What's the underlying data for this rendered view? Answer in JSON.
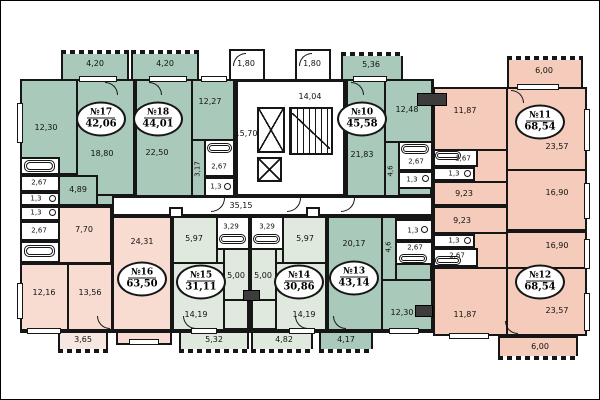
{
  "colors": {
    "apartment_green": "#a9c9ba",
    "apartment_pale_green": "#dfe9dd",
    "apartment_pink": "#f5ccbb",
    "apartment_light_pink": "#f8dcd1",
    "balcony_light_pink": "#f6e7e1",
    "wall": "#161616",
    "background": "#ffffff"
  },
  "core": {
    "entry_left": "1,80",
    "entry_right": "1,80",
    "stairwell": "14,04",
    "elevator_hall": "15,70",
    "corridor": "35,15"
  },
  "apartments": {
    "a17": {
      "number": "№17",
      "area": "42,06",
      "balcony": "4,20",
      "rooms": {
        "room1": "12,30",
        "room2": "18,80",
        "hall": "4,89",
        "bath": "2,67",
        "wc": "1,3"
      }
    },
    "a18": {
      "number": "№18",
      "area": "44,01",
      "balcony": "4,20",
      "rooms": {
        "room1": "22,50",
        "room2": "12,27",
        "hall": "3,17",
        "bath": "2,67",
        "wc": "1,3"
      }
    },
    "a10": {
      "number": "№10",
      "area": "45,58",
      "balcony": "5,36",
      "rooms": {
        "room1": "21,83",
        "room2": "12,48",
        "hall": "4,6",
        "bath": "2,67",
        "wc": "1,3"
      }
    },
    "a11": {
      "number": "№11",
      "area": "68,54",
      "balcony": "6,00",
      "rooms": {
        "room1": "11,87",
        "room2": "23,57",
        "room3": "16,90",
        "room4": "9,23",
        "bath": "2,67",
        "wc": "1,3"
      }
    },
    "a12": {
      "number": "№12",
      "area": "68,54",
      "balcony": "6,00",
      "rooms": {
        "room1": "11,87",
        "room2": "23,57",
        "room3": "16,90",
        "room4": "9,23",
        "bath": "2,67",
        "wc": "1,3"
      }
    },
    "a13": {
      "number": "№13",
      "area": "43,14",
      "balcony": "4,17",
      "rooms": {
        "room1": "20,17",
        "room2": "12,30",
        "hall": "4,6",
        "bath": "2,67",
        "wc": "1,3"
      }
    },
    "a14": {
      "number": "№14",
      "area": "30,86",
      "balcony": "4,82",
      "rooms": {
        "room1": "14,19",
        "room2": "5,97",
        "kitchen": "5,00",
        "bath": "3,29"
      }
    },
    "a15": {
      "number": "№15",
      "area": "31,11",
      "balcony": "5,32",
      "rooms": {
        "room1": "14,19",
        "room2": "5,97",
        "kitchen": "5,00",
        "bath": "3,29"
      }
    },
    "a16": {
      "number": "№16",
      "area": "63,50",
      "balcony": "3,65",
      "rooms": {
        "room1": "24,31",
        "room2": "12,16",
        "room3": "13,56",
        "hall": "7,70",
        "bath": "2,67",
        "wc": "1,3"
      }
    }
  }
}
